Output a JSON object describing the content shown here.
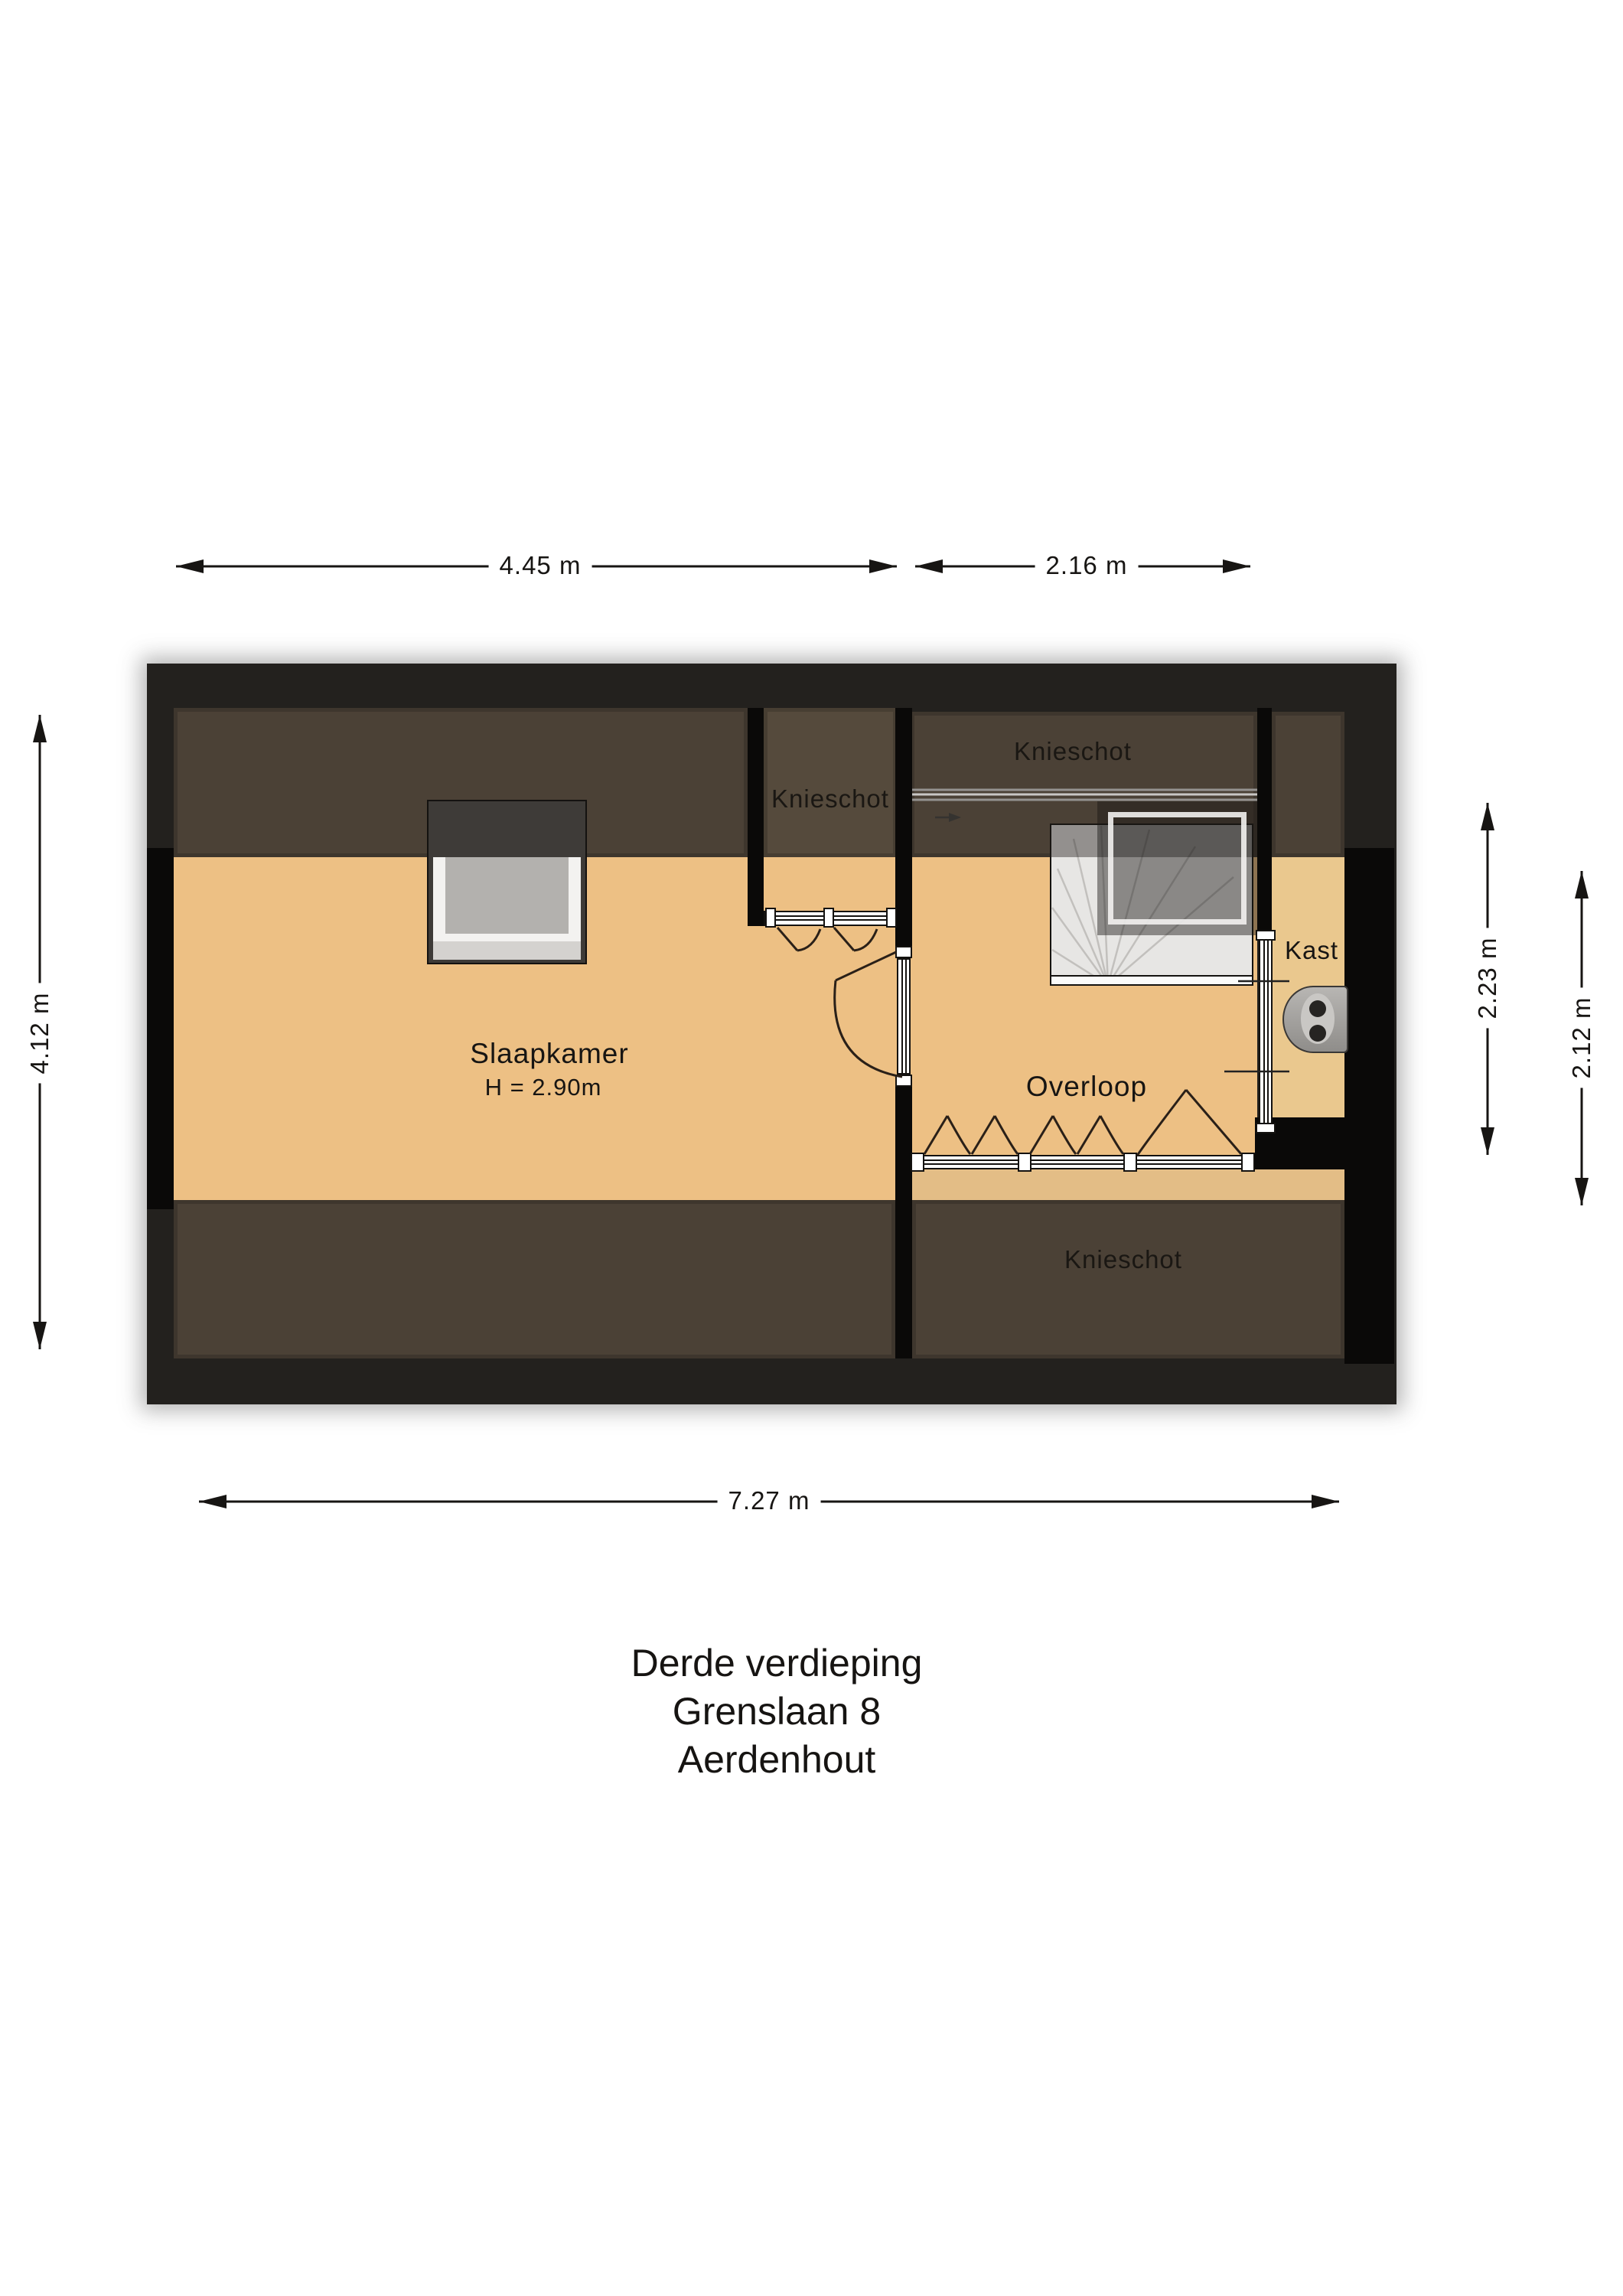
{
  "title": {
    "line1": "Derde verdieping",
    "line2": "Grenslaan 8",
    "line3": "Aerdenhout"
  },
  "dimensions": {
    "top_left": "4.45 m",
    "top_right": "2.16 m",
    "bottom": "7.27 m",
    "left": "4.12 m",
    "right_inner": "2.23 m",
    "right_outer": "2.12 m"
  },
  "rooms": {
    "bedroom": {
      "name": "Slaapkamer",
      "ceiling_height": "H = 2.90m"
    },
    "landing": {
      "name": "Overloop"
    },
    "closet": {
      "name": "Kast"
    },
    "knee_wall_labels": [
      "Knieschot",
      "Knieschot",
      "Knieschot"
    ]
  },
  "colors": {
    "wall_outer": "#23211e",
    "wall_black": "#0a0908",
    "knee_wall_brown": "#4b4136",
    "closet_brown": "#554a3c",
    "floor_orange": "#edc084",
    "floor_kast": "#eac88e",
    "floor_strip": "#e3bd86",
    "stairs_light": "#e7e6e4",
    "window_dark": "#3e3b38",
    "window_pane": "#b3b1ae",
    "appliance_gray": "#a5a3a0",
    "dimension_ink": "#171513"
  }
}
